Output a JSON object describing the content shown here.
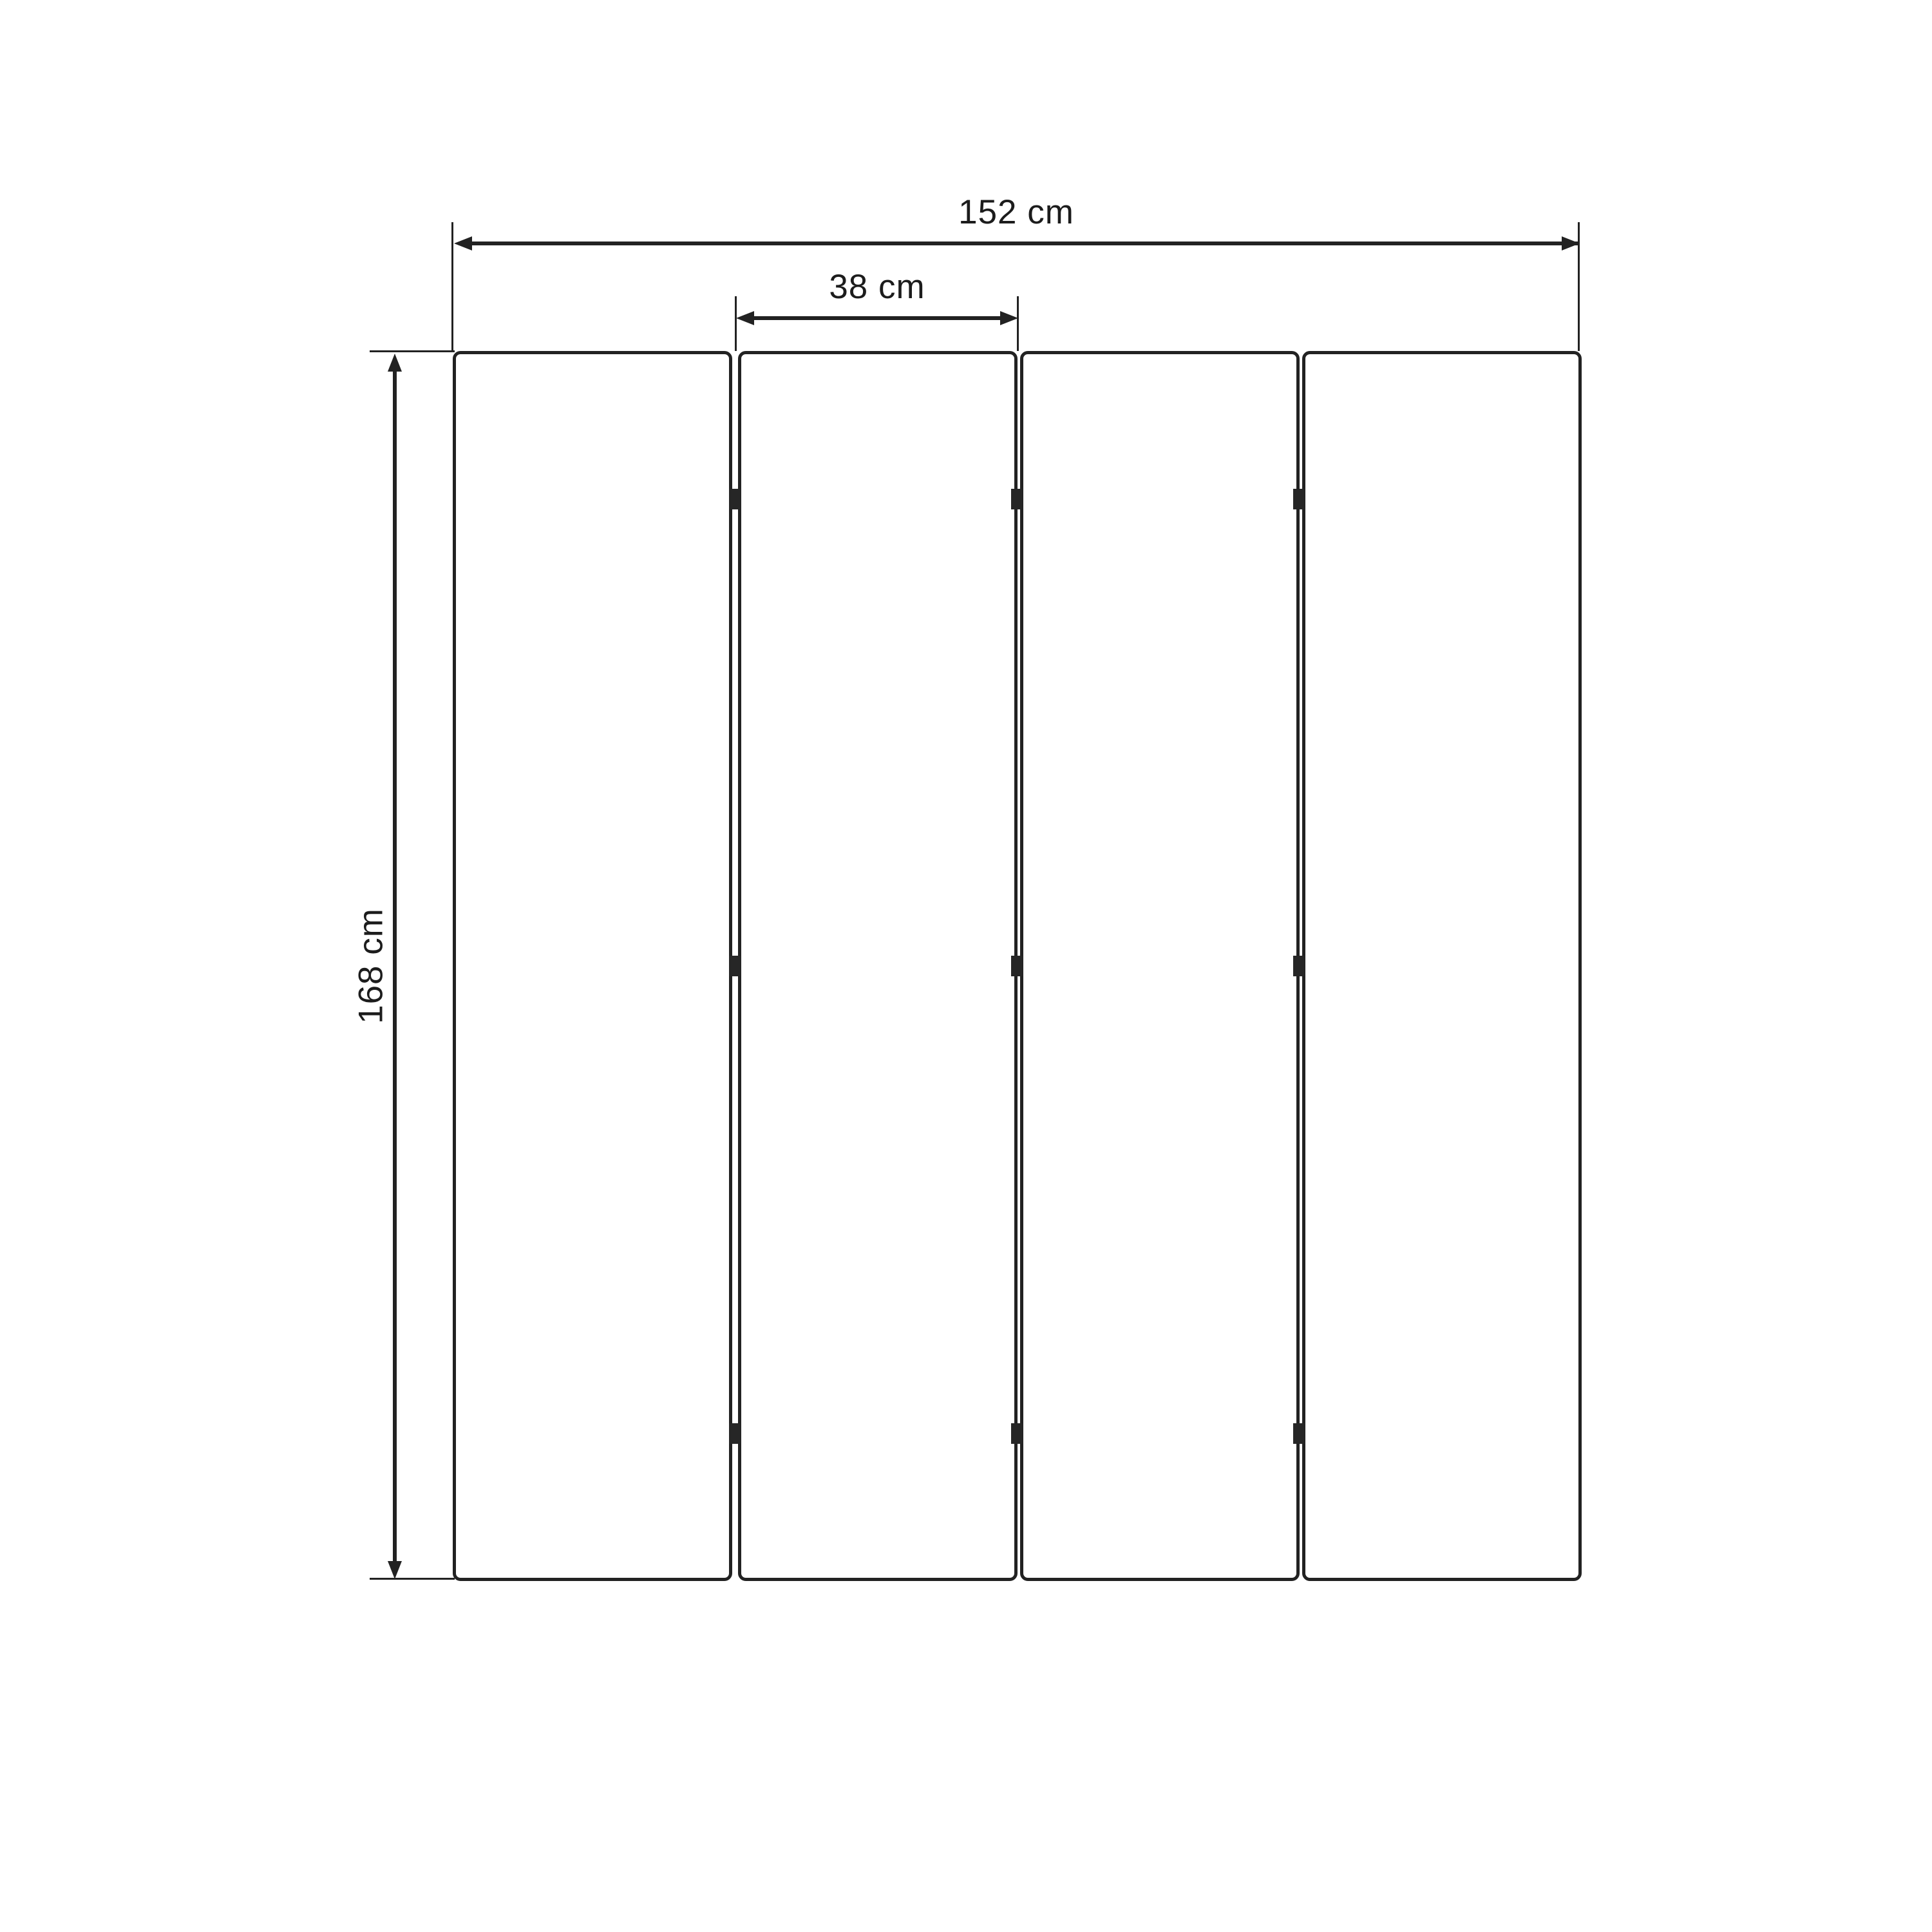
{
  "diagram": {
    "panel_count": 4,
    "hinge_rows_per_joint": 3,
    "dimensions": {
      "total_width": {
        "label": "152 cm",
        "value": 152,
        "unit": "cm"
      },
      "panel_width": {
        "label": "38 cm",
        "value": 38,
        "unit": "cm"
      },
      "height": {
        "label": "168 cm",
        "value": 168,
        "unit": "cm"
      }
    },
    "colors": {
      "line": "#222222",
      "text": "#1c1c1c",
      "background": "#ffffff"
    }
  }
}
